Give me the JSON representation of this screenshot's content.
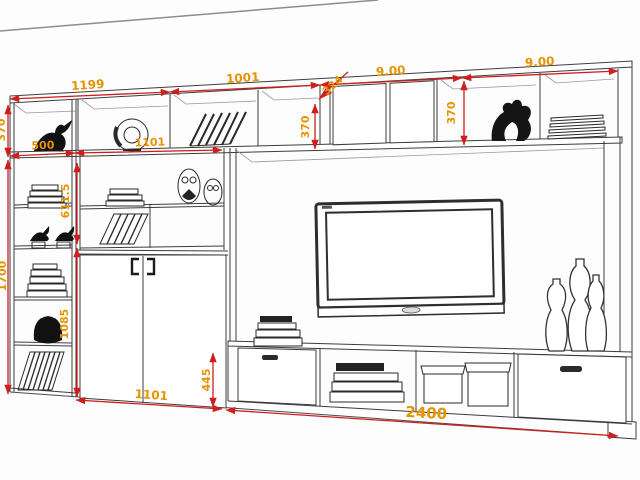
{
  "drawing": {
    "type": "wall-unit-elevation",
    "colors": {
      "background": "#fdfdfd",
      "linework": "#3d3d3d",
      "wall_line": "#8c8c8c",
      "dimension_line": "#ce1f1f",
      "dimension_text": "#e59400"
    },
    "dimensions": {
      "top_widths": [
        "1199",
        "1001",
        "9.00",
        "9.00"
      ],
      "shelf_widths": {
        "left": "500",
        "middle": "1101"
      },
      "heights": {
        "top_left": "370",
        "middle": "370",
        "right": "370",
        "left_upper": "611.5",
        "left_total": "1700",
        "left_lower": "1085",
        "bench": "445"
      },
      "bottom_widths": {
        "cabinet": "1101",
        "bench": "2400"
      },
      "depth_diagonal": "324"
    }
  }
}
